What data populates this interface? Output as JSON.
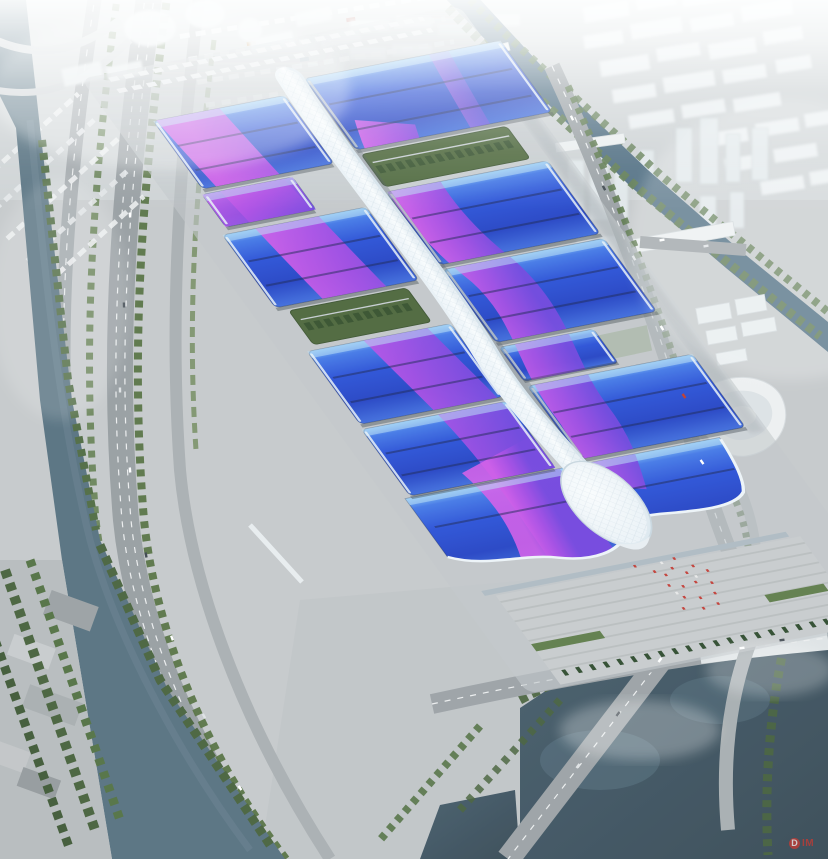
{
  "image": {
    "width": 828,
    "height": 859,
    "description": "Aerial rendering of a vast exhibition and convention center: rows of blue hall roofs swept by purple ribbons, joined by a white serpentine central concourse canopy, with surrounding roads, parking, canals, a lake, waterfront parks and a hazy white city skyline."
  },
  "watermark": {
    "logo": "D",
    "text": "IM",
    "color": "#b5342c"
  },
  "palette": {
    "roof-deep": "#2a50d6",
    "roof-light": "#7fc0f4",
    "ribbon-purple": "#9a4ae0",
    "ribbon-magenta": "#d45ae8",
    "spine-white": "#f7fafc",
    "ground": "#c6c9cb",
    "road": "#9aa0a4",
    "water-river": "#56707f",
    "water-lake": "#3e525f",
    "water-canal": "#4e6c80",
    "tree-green": "#527042",
    "lawn-green": "#7e9a6a",
    "haze-white": "#f2f5f6",
    "flag-red": "#c23b34"
  }
}
